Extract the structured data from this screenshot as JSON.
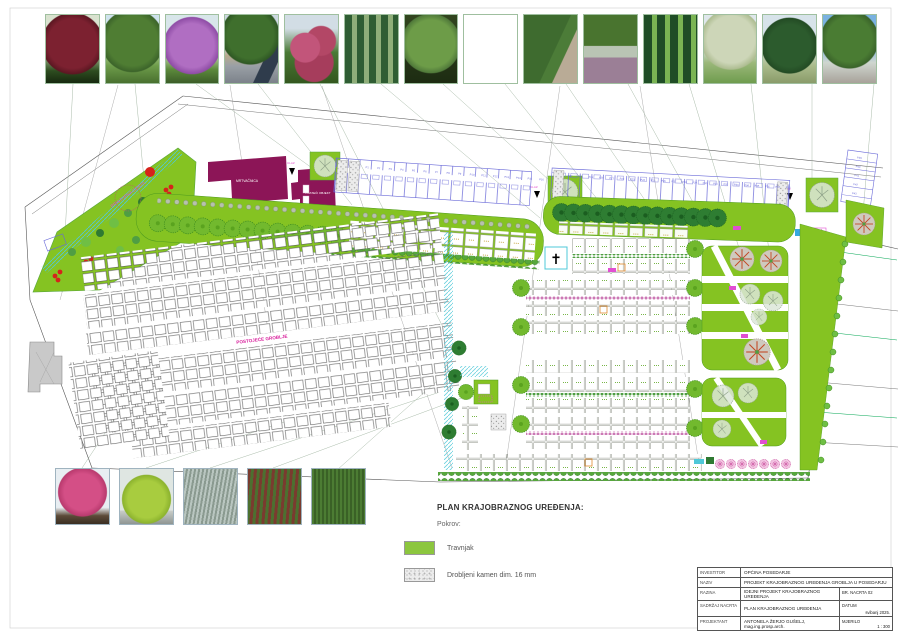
{
  "legend": {
    "title": "PLAN KRAJOBRAZNOG UREĐENJA:",
    "subtitle": "Pokrov:",
    "items": [
      {
        "label": "Travnjak",
        "swatch": "grass",
        "color": "#8CC63E"
      },
      {
        "label": "Drobljeni kamen dim. 16 mm",
        "swatch": "gravel",
        "color": "#ECECEC"
      }
    ]
  },
  "title_block": {
    "rows": [
      {
        "label": "INVESTITOR",
        "value": "OPĆINA POSEDARJE"
      },
      {
        "label": "NAZIV",
        "value": "PROJEKT KRAJOBRAZNOG UREĐENJA GROBLJA U POSEDARJU"
      },
      {
        "label": "RAZINA",
        "value": "IDEJNI PROJEKT KRAJOBRAZNOG UREĐENJA",
        "extra_label": "BR. NACRTA 02",
        "extra_value": ""
      },
      {
        "label": "SADRŽAJ NACRTA",
        "value": "PLAN KRAJOBRAZNOG UREĐENJA",
        "extra_label": "DATUM",
        "extra_value": "svibanj 2025."
      },
      {
        "label": "PROJEKTANT",
        "value": "ANTONELA ŽERJO GUŠELJ, mag.ing.prosp.arch.",
        "extra_label": "MJERILO",
        "extra_value": "1 : 300"
      }
    ]
  },
  "plan": {
    "existing_cemetery_label": "POSTOJEĆE GROBLJE",
    "road_label": "PRISTUPNA CESTA",
    "entrance_label": "ULAZ",
    "building1_label": "MRTVAČNICA",
    "building2_label": "PRATEĆI OBJEKT",
    "cross_symbol": "✝",
    "colors": {
      "grass": "#85C322",
      "tree_dark": "#2E7D32",
      "building": "#8C1557",
      "parking_lines": "#6A6AD8",
      "cyan_path": "#4FC8D8",
      "accent_magenta": "#D81B9A"
    }
  },
  "parking": {
    "lot_a": [
      "P1",
      "P2",
      "P3",
      "P4",
      "P5",
      "P6",
      "P7",
      "P8",
      "P9",
      "P10",
      "P11",
      "P12",
      "P13",
      "P14",
      "P15",
      "P16"
    ],
    "lot_b": [
      "P17",
      "P18",
      "P19",
      "P20",
      "P21",
      "P22",
      "P23",
      "P24",
      "P25",
      "P26",
      "P27",
      "P28",
      "P29",
      "P30",
      "P31",
      "P32",
      "P33",
      "P34",
      "P35",
      "P36",
      "P37",
      "P38"
    ],
    "lot_c": [
      "P39",
      "P40",
      "P41",
      "P42",
      "P43",
      "P44"
    ]
  },
  "photos_top": [
    {
      "alt": "red-leaf ornamental tree"
    },
    {
      "alt": "spreading green tree on lawn"
    },
    {
      "alt": "purple flowering crape myrtle"
    },
    {
      "alt": "round-crown street tree"
    },
    {
      "alt": "pink oleander shrub mass"
    },
    {
      "alt": "columnar hornbeam nursery rows"
    },
    {
      "alt": "white flowering shrub tree"
    },
    {
      "alt": "pleached trees along wall"
    },
    {
      "alt": "green hedge along gravel path"
    },
    {
      "alt": "hedge with lavender border"
    },
    {
      "alt": "italian cypress group"
    },
    {
      "alt": "white blossom spreading tree"
    },
    {
      "alt": "conical conifers"
    },
    {
      "alt": "round street tree, blue sky"
    }
  ],
  "photos_bottom": [
    {
      "alt": "pink azalea shrub"
    },
    {
      "alt": "lime green ball shrub"
    },
    {
      "alt": "silver groundcover"
    },
    {
      "alt": "red-green photinia hedge"
    },
    {
      "alt": "clipped green hedge"
    }
  ]
}
